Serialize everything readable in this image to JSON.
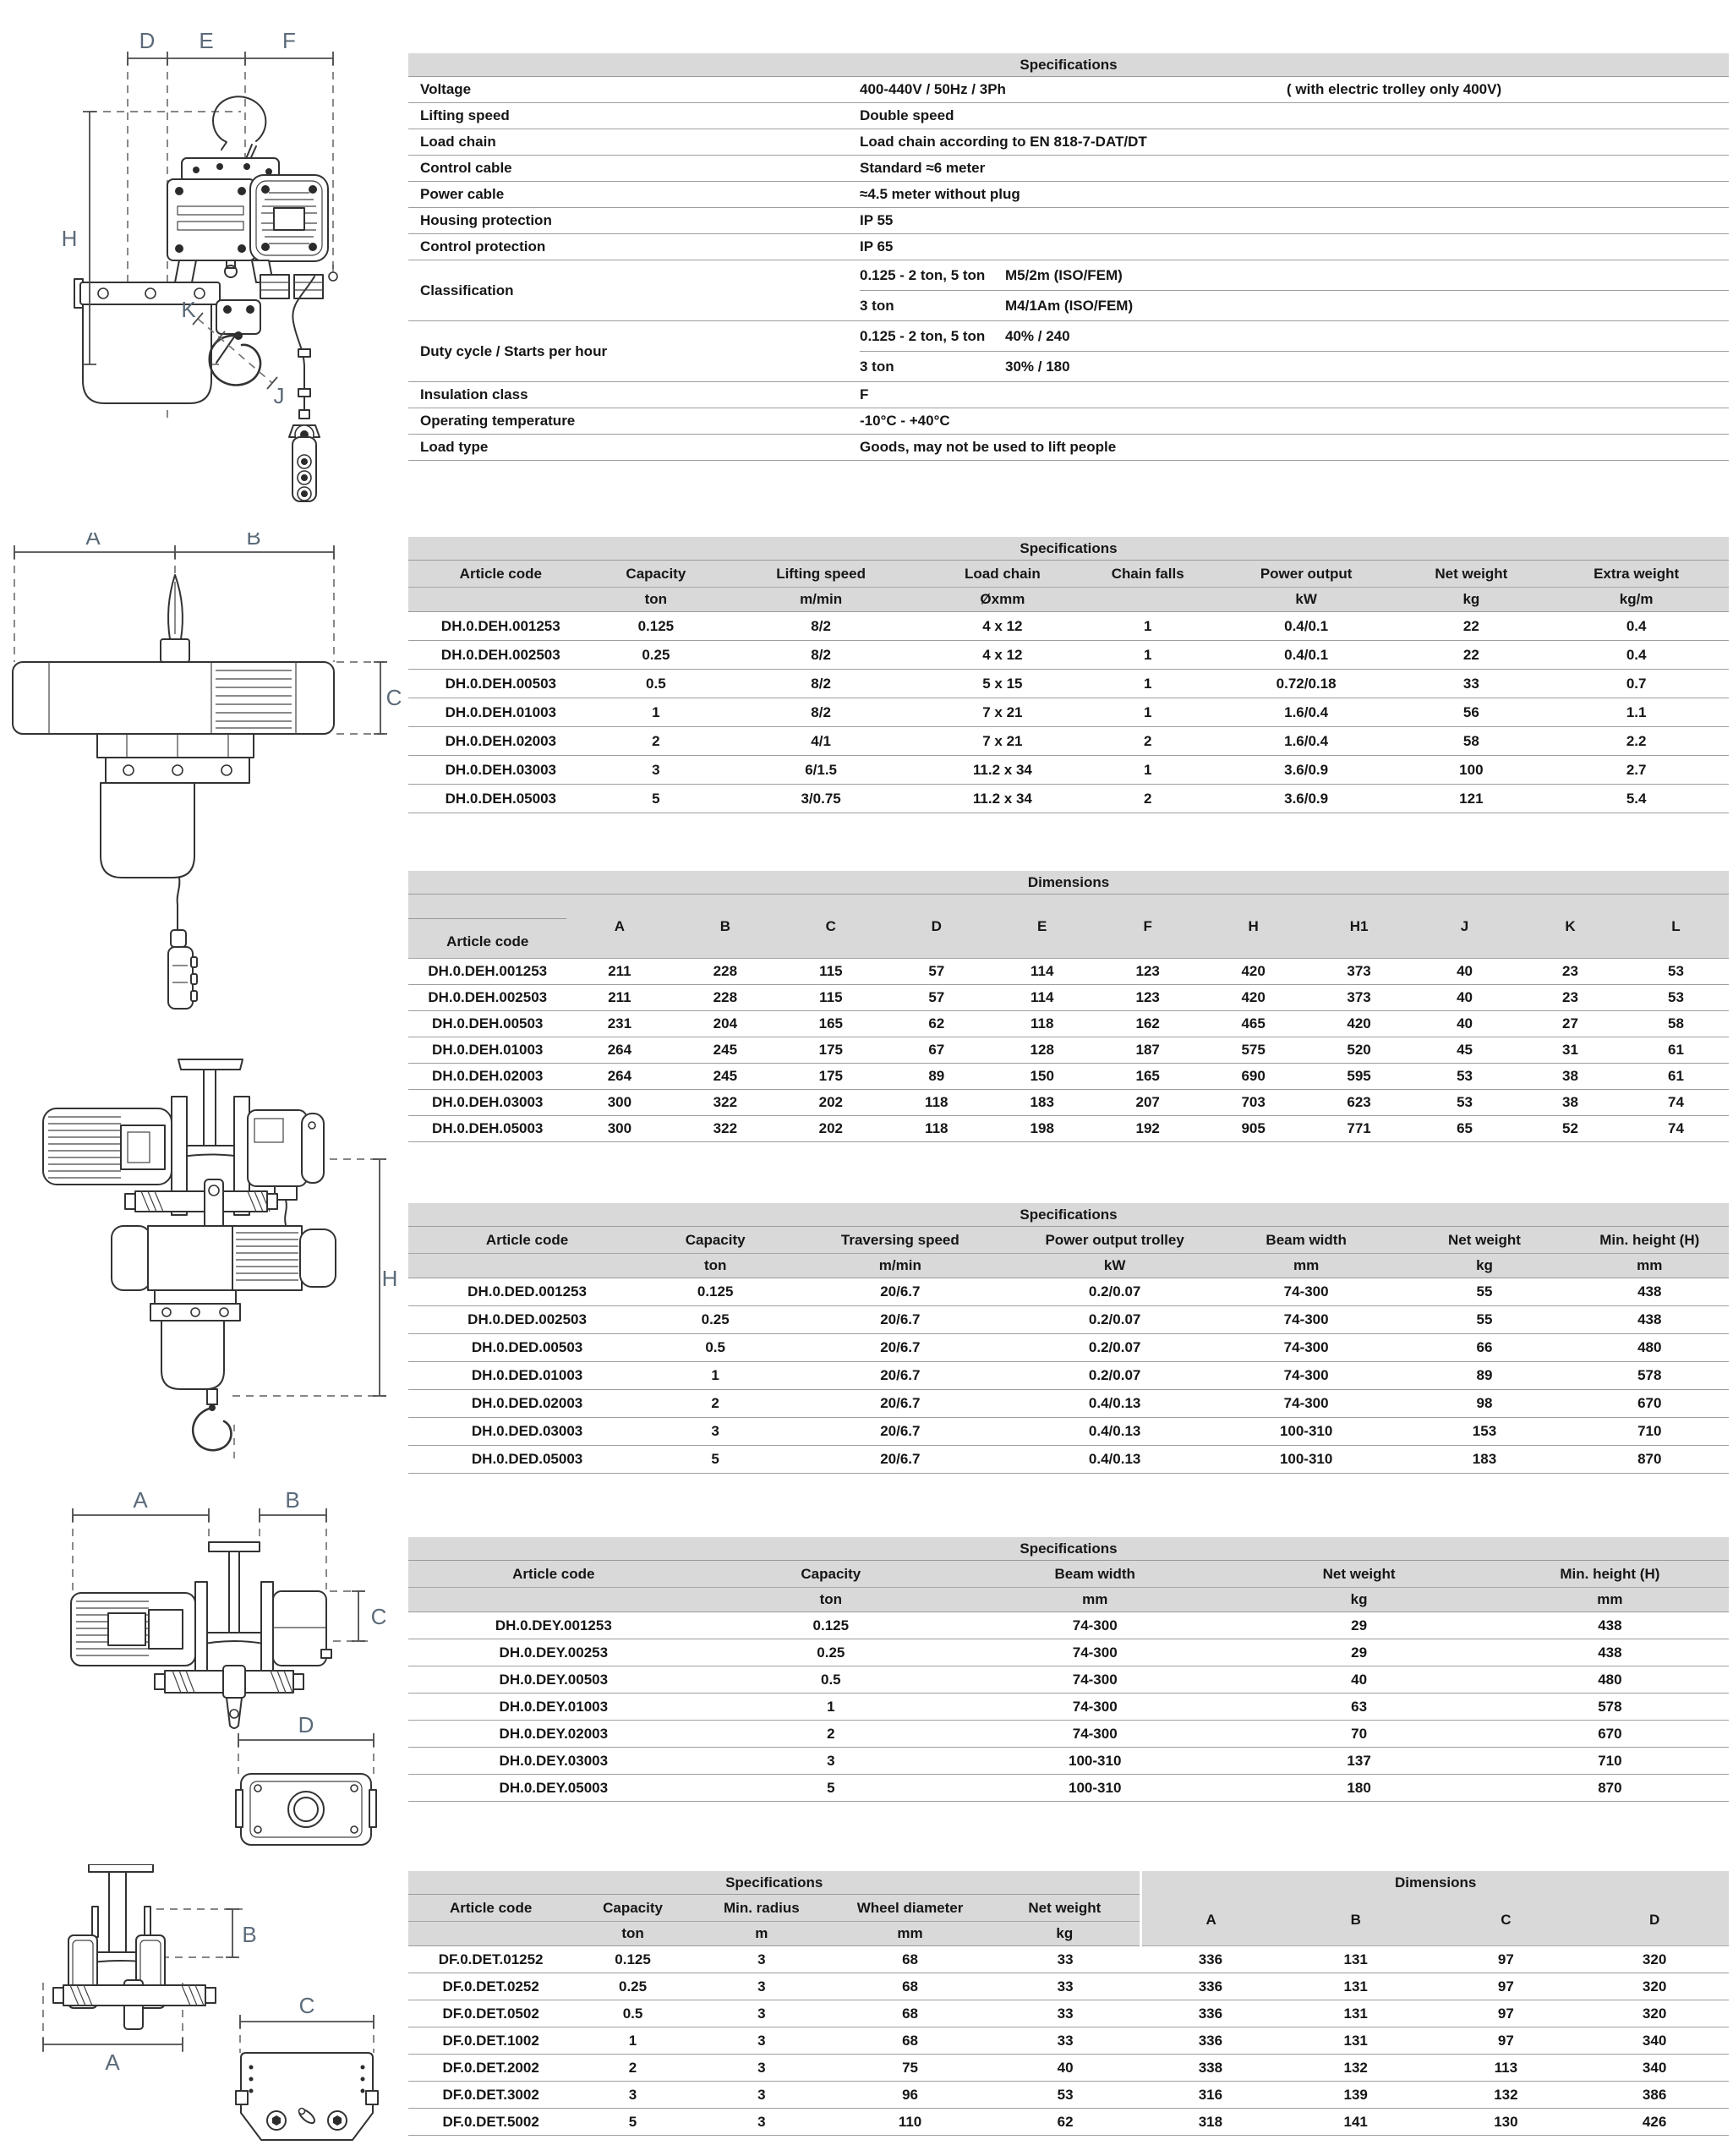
{
  "page": {
    "background": "#ffffff"
  },
  "colors": {
    "table_header_bg": "#d9d9d9",
    "grid_line": "#9e9e9e",
    "dimension_label": "#5b6a79",
    "line_art": "#333333",
    "text": "#161616"
  },
  "overview": {
    "title": "Specifications",
    "rows": [
      {
        "label": "Voltage",
        "value": "400-440V / 50Hz / 3Ph",
        "note": "( with electric trolley only 400V)"
      },
      {
        "label": "Lifting speed",
        "value": "Double speed"
      },
      {
        "label": "Load chain",
        "value": "Load chain according to EN 818-7-DAT/DT"
      },
      {
        "label": "Control cable",
        "value": "Standard ≈6 meter"
      },
      {
        "label": "Power cable",
        "value": "≈4.5 meter without plug"
      },
      {
        "label": "Housing protection",
        "value": "IP 55"
      },
      {
        "label": "Control protection",
        "value": "IP 65"
      },
      {
        "label": "Classification",
        "sub": [
          [
            "0.125 - 2 ton, 5 ton",
            "M5/2m (ISO/FEM)"
          ],
          [
            "3 ton",
            "M4/1Am (ISO/FEM)"
          ]
        ]
      },
      {
        "label": "Duty cycle / Starts per hour",
        "sub": [
          [
            "0.125 - 2 ton, 5 ton",
            "40% / 240"
          ],
          [
            "3 ton",
            "30% / 180"
          ]
        ]
      },
      {
        "label": "Insulation class",
        "value": "F"
      },
      {
        "label": "Operating temperature",
        "value": "-10°C - +40°C"
      },
      {
        "label": "Load type",
        "value": "Goods, may not be used to lift people"
      }
    ]
  },
  "hoist_specs": {
    "title": "Specifications",
    "columns": [
      "Article code",
      "Capacity",
      "Lifting speed",
      "Load chain",
      "Chain falls",
      "Power output",
      "Net weight",
      "Extra weight"
    ],
    "units": [
      "",
      "ton",
      "m/min",
      "Øxmm",
      "",
      "kW",
      "kg",
      "kg/m"
    ],
    "rows": [
      [
        "DH.0.DEH.001253",
        "0.125",
        "8/2",
        "4 x 12",
        "1",
        "0.4/0.1",
        "22",
        "0.4"
      ],
      [
        "DH.0.DEH.002503",
        "0.25",
        "8/2",
        "4 x 12",
        "1",
        "0.4/0.1",
        "22",
        "0.4"
      ],
      [
        "DH.0.DEH.00503",
        "0.5",
        "8/2",
        "5 x 15",
        "1",
        "0.72/0.18",
        "33",
        "0.7"
      ],
      [
        "DH.0.DEH.01003",
        "1",
        "8/2",
        "7 x 21",
        "1",
        "1.6/0.4",
        "56",
        "1.1"
      ],
      [
        "DH.0.DEH.02003",
        "2",
        "4/1",
        "7 x 21",
        "2",
        "1.6/0.4",
        "58",
        "2.2"
      ],
      [
        "DH.0.DEH.03003",
        "3",
        "6/1.5",
        "11.2 x 34",
        "1",
        "3.6/0.9",
        "100",
        "2.7"
      ],
      [
        "DH.0.DEH.05003",
        "5",
        "3/0.75",
        "11.2 x 34",
        "2",
        "3.6/0.9",
        "121",
        "5.4"
      ]
    ]
  },
  "hoist_dimensions": {
    "title": "Dimensions",
    "columns": [
      "Article code",
      "A",
      "B",
      "C",
      "D",
      "E",
      "F",
      "H",
      "H1",
      "J",
      "K",
      "L"
    ],
    "rows": [
      [
        "DH.0.DEH.001253",
        "211",
        "228",
        "115",
        "57",
        "114",
        "123",
        "420",
        "373",
        "40",
        "23",
        "53"
      ],
      [
        "DH.0.DEH.002503",
        "211",
        "228",
        "115",
        "57",
        "114",
        "123",
        "420",
        "373",
        "40",
        "23",
        "53"
      ],
      [
        "DH.0.DEH.00503",
        "231",
        "204",
        "165",
        "62",
        "118",
        "162",
        "465",
        "420",
        "40",
        "27",
        "58"
      ],
      [
        "DH.0.DEH.01003",
        "264",
        "245",
        "175",
        "67",
        "128",
        "187",
        "575",
        "520",
        "45",
        "31",
        "61"
      ],
      [
        "DH.0.DEH.02003",
        "264",
        "245",
        "175",
        "89",
        "150",
        "165",
        "690",
        "595",
        "53",
        "38",
        "61"
      ],
      [
        "DH.0.DEH.03003",
        "300",
        "322",
        "202",
        "118",
        "183",
        "207",
        "703",
        "623",
        "53",
        "38",
        "74"
      ],
      [
        "DH.0.DEH.05003",
        "300",
        "322",
        "202",
        "118",
        "198",
        "192",
        "905",
        "771",
        "65",
        "52",
        "74"
      ]
    ]
  },
  "electric_trolley_specs": {
    "title": "Specifications",
    "columns": [
      "Article code",
      "Capacity",
      "Traversing speed",
      "Power output trolley",
      "Beam width",
      "Net weight",
      "Min. height (H)"
    ],
    "units": [
      "",
      "ton",
      "m/min",
      "kW",
      "mm",
      "kg",
      "mm"
    ],
    "rows": [
      [
        "DH.0.DED.001253",
        "0.125",
        "20/6.7",
        "0.2/0.07",
        "74-300",
        "55",
        "438"
      ],
      [
        "DH.0.DED.002503",
        "0.25",
        "20/6.7",
        "0.2/0.07",
        "74-300",
        "55",
        "438"
      ],
      [
        "DH.0.DED.00503",
        "0.5",
        "20/6.7",
        "0.2/0.07",
        "74-300",
        "66",
        "480"
      ],
      [
        "DH.0.DED.01003",
        "1",
        "20/6.7",
        "0.2/0.07",
        "74-300",
        "89",
        "578"
      ],
      [
        "DH.0.DED.02003",
        "2",
        "20/6.7",
        "0.4/0.13",
        "74-300",
        "98",
        "670"
      ],
      [
        "DH.0.DED.03003",
        "3",
        "20/6.7",
        "0.4/0.13",
        "100-310",
        "153",
        "710"
      ],
      [
        "DH.0.DED.05003",
        "5",
        "20/6.7",
        "0.4/0.13",
        "100-310",
        "183",
        "870"
      ]
    ]
  },
  "push_trolley_specs": {
    "title": "Specifications",
    "columns": [
      "Article code",
      "Capacity",
      "Beam width",
      "Net weight",
      "Min. height (H)"
    ],
    "units": [
      "",
      "ton",
      "mm",
      "kg",
      "mm"
    ],
    "rows": [
      [
        "DH.0.DEY.001253",
        "0.125",
        "74-300",
        "29",
        "438"
      ],
      [
        "DH.0.DEY.00253",
        "0.25",
        "74-300",
        "29",
        "438"
      ],
      [
        "DH.0.DEY.00503",
        "0.5",
        "74-300",
        "40",
        "480"
      ],
      [
        "DH.0.DEY.01003",
        "1",
        "74-300",
        "63",
        "578"
      ],
      [
        "DH.0.DEY.02003",
        "2",
        "74-300",
        "70",
        "670"
      ],
      [
        "DH.0.DEY.03003",
        "3",
        "100-310",
        "137",
        "710"
      ],
      [
        "DH.0.DEY.05003",
        "5",
        "100-310",
        "180",
        "870"
      ]
    ]
  },
  "beam_trolley": {
    "title": [
      {
        "label": "Specifications",
        "span": 5
      },
      {
        "label": "Dimensions",
        "span": 4
      }
    ],
    "columns": [
      "Article code",
      "Capacity",
      "Min. radius",
      "Wheel diameter",
      "Net weight",
      "A",
      "B",
      "C",
      "D"
    ],
    "units": [
      "",
      "ton",
      "m",
      "mm",
      "kg"
    ],
    "rows": [
      [
        "DF.0.DET.01252",
        "0.125",
        "3",
        "68",
        "33",
        "336",
        "131",
        "97",
        "320"
      ],
      [
        "DF.0.DET.0252",
        "0.25",
        "3",
        "68",
        "33",
        "336",
        "131",
        "97",
        "320"
      ],
      [
        "DF.0.DET.0502",
        "0.5",
        "3",
        "68",
        "33",
        "336",
        "131",
        "97",
        "320"
      ],
      [
        "DF.0.DET.1002",
        "1",
        "3",
        "68",
        "33",
        "336",
        "131",
        "97",
        "340"
      ],
      [
        "DF.0.DET.2002",
        "2",
        "3",
        "75",
        "40",
        "338",
        "132",
        "113",
        "340"
      ],
      [
        "DF.0.DET.3002",
        "3",
        "3",
        "96",
        "53",
        "316",
        "139",
        "132",
        "386"
      ],
      [
        "DF.0.DET.5002",
        "5",
        "3",
        "110",
        "62",
        "318",
        "141",
        "130",
        "426"
      ]
    ]
  },
  "drawings": {
    "hoist_front": {
      "labels": {
        "d": "D",
        "e": "E",
        "f": "F",
        "h": "H",
        "k": "K",
        "j": "J"
      }
    },
    "hoist_side": {
      "labels": {
        "a": "A",
        "b": "B",
        "c": "C"
      }
    },
    "hoist_with_trolley": {
      "labels": {
        "h": "H"
      }
    },
    "electric_trolley": {
      "labels": {
        "a": "A",
        "b": "B",
        "c": "C",
        "d": "D"
      }
    },
    "push_trolley": {
      "labels": {
        "a": "A",
        "b": "B",
        "c": "C"
      }
    }
  }
}
